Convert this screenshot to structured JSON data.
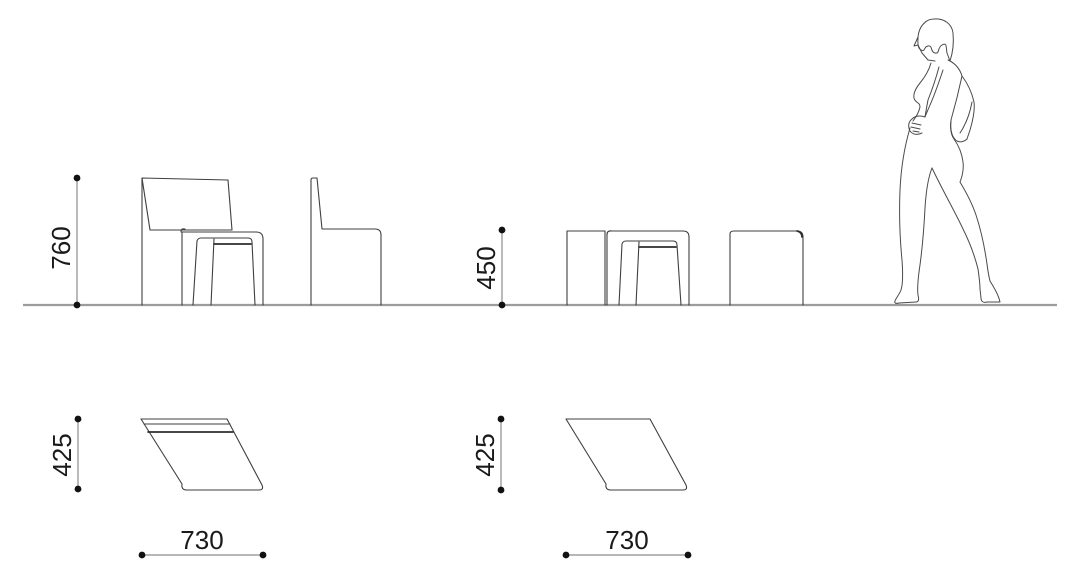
{
  "colors": {
    "background": "#ffffff",
    "outline": "#3f3f3f",
    "dimension": "#8c8c8c",
    "ground": "#9c9c9c",
    "text": "#1a1a1a"
  },
  "drawing": {
    "elevation": {
      "chair_height_label": "760",
      "stool_height_label": "450"
    },
    "plan_left": {
      "depth_label": "425",
      "width_label": "730"
    },
    "plan_right": {
      "depth_label": "425",
      "width_label": "730"
    }
  }
}
